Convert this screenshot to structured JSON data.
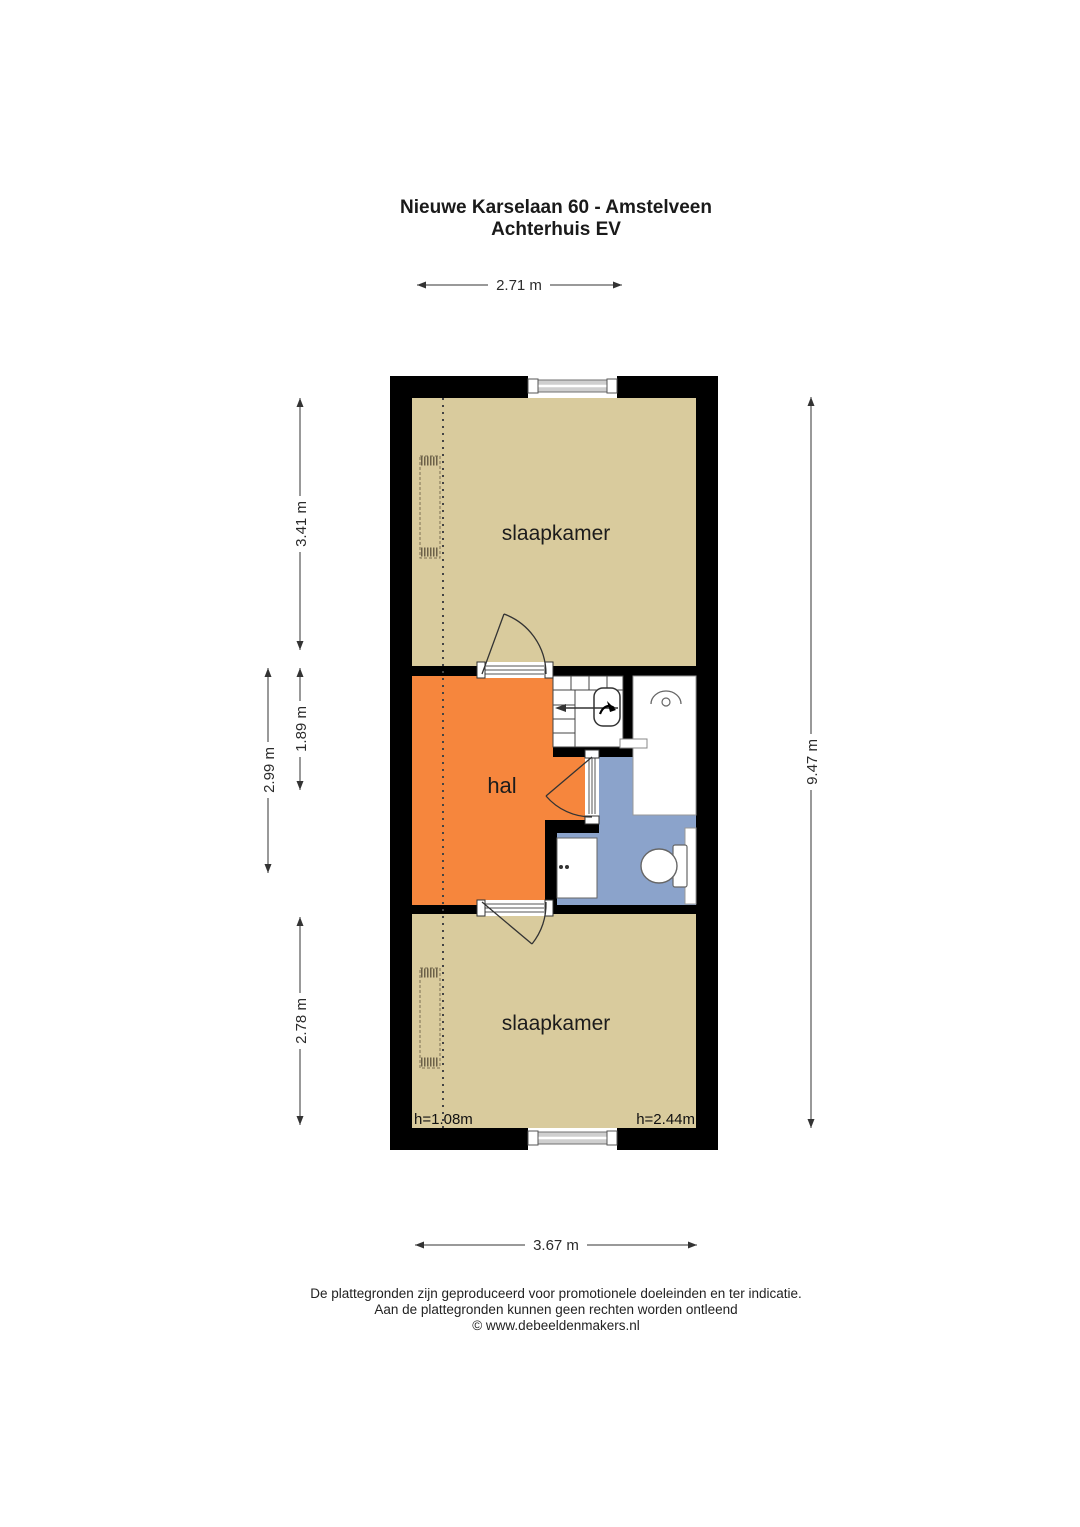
{
  "title": {
    "line1": "Nieuwe Karselaan 60 - Amstelveen",
    "line2": "Achterhuis EV"
  },
  "plan": {
    "room_labels": {
      "bedroom_top": "slaapkamer",
      "hall": "hal",
      "bedroom_bottom": "slaapkamer"
    },
    "ceiling_heights": {
      "left": "h=1.08m",
      "right": "h=2.44m"
    }
  },
  "dimensions": {
    "top_width": "2.71 m",
    "bedroom_top_depth": "3.41 m",
    "middle_depth": "2.99 m",
    "hall_depth": "1.89 m",
    "bedroom_bottom_depth": "2.78 m",
    "total_depth": "9.47 m",
    "bottom_width": "3.67 m"
  },
  "footer": {
    "line1": "De plattegronden zijn geproduceerd voor promotionele doeleinden en ter indicatie.",
    "line2": "Aan de plattegronden kunnen geen rechten worden ontleend",
    "line3": "© www.debeeldenmakers.nl"
  },
  "colors": {
    "bedroom_fill": "#d9cb9d",
    "hall_fill": "#f6863d",
    "bathroom_fill": "#8ba3cb",
    "wall": "#000000"
  }
}
